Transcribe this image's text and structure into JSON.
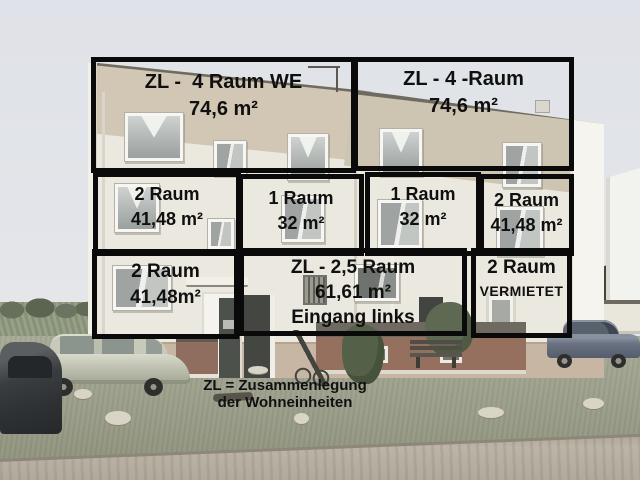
{
  "photo": {
    "subject": "Three-storey apartment building with annotated flat units, cars and lawn in front",
    "colors": {
      "box_border": "#0a0a0a",
      "annotation_text": "#101010",
      "sky": "#e2e5e9",
      "wall_upper_band": "#d0c6b3",
      "wall_lower": "#ebe8df",
      "grass": "#a0a38e",
      "road": "#b5ae9f"
    }
  },
  "overlay": {
    "units": [
      {
        "name": "top-left",
        "lines": [
          "ZL -  4 Raum WE",
          "74,6 m²"
        ]
      },
      {
        "name": "top-right",
        "lines": [
          "ZL - 4 -Raum",
          "74,6 m²"
        ]
      },
      {
        "name": "middle-1",
        "lines": [
          "2 Raum",
          "41,48 m²"
        ]
      },
      {
        "name": "middle-2",
        "lines": [
          "1 Raum",
          "32 m²"
        ]
      },
      {
        "name": "middle-3",
        "lines": [
          "1 Raum",
          "32 m²"
        ]
      },
      {
        "name": "middle-4",
        "lines": [
          "2 Raum",
          "41,48 m²"
        ]
      },
      {
        "name": "bottom-1",
        "lines": [
          "2 Raum",
          "41,48m²"
        ]
      },
      {
        "name": "bottom-2",
        "lines": [
          "ZL - 2,5 Raum",
          "61,61 m²",
          "Eingang links"
        ]
      },
      {
        "name": "bottom-3",
        "lines": [
          "2 Raum",
          "VERMIETET"
        ]
      }
    ],
    "legend": {
      "line1": "ZL = Zusammenlegung",
      "line2": "der Wohneinheiten"
    }
  }
}
